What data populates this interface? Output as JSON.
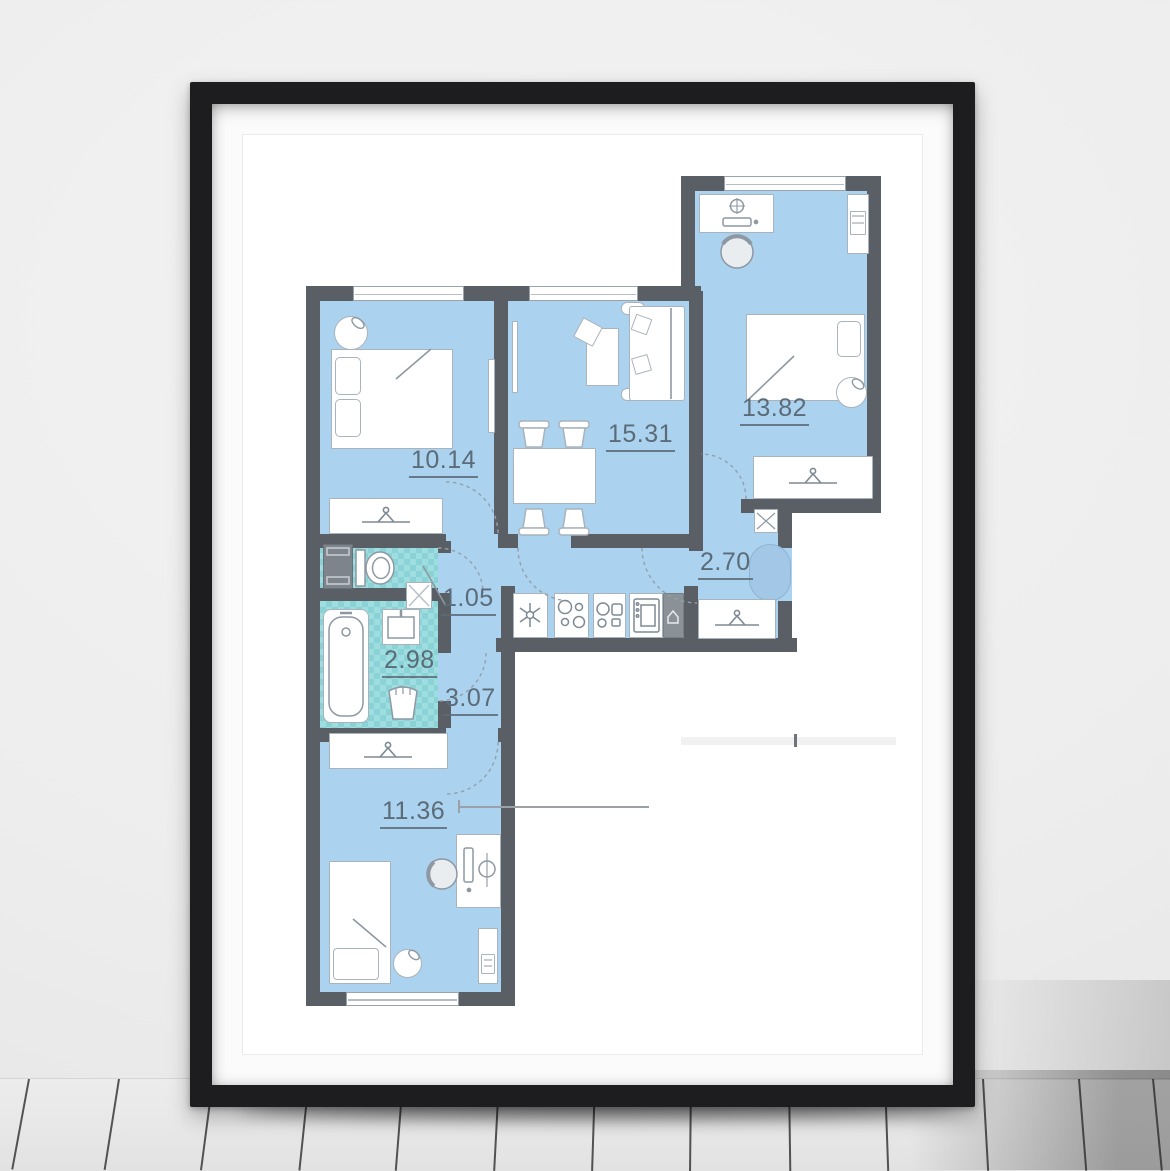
{
  "poster": {
    "kind": "apartment floor plan, black frame on white wall over whitewashed wood floor",
    "total_rooms_labeled": 8
  },
  "rooms": [
    {
      "name": "bedroom-top-left",
      "area": "10.14"
    },
    {
      "name": "living-room",
      "area": "15.31"
    },
    {
      "name": "bedroom-top-right",
      "area": "13.82"
    },
    {
      "name": "entry-hall",
      "area": "2.70"
    },
    {
      "name": "wc",
      "area": "1.05"
    },
    {
      "name": "bathroom",
      "area": "2.98"
    },
    {
      "name": "inner-hall",
      "area": "3.07"
    },
    {
      "name": "bedroom-bottom",
      "area": "11.36"
    }
  ],
  "colors": {
    "room_fill": "#abd2ef",
    "wet_room_tile": "#9edde0",
    "wall": "#5a5f66",
    "area_label": "#5c6b78",
    "entry_rug": "#a3c7e6",
    "furniture_outline": "#a9b3bc",
    "frame": "#1d1d1f",
    "paper": "#ffffff"
  },
  "icons": {
    "hanger": "wardrobe clothes-hanger glyph",
    "snowflake": "fridge snowflake glyph",
    "burners": "cooktop four-burner glyph",
    "dishes": "kitchen sink with dishes glyph",
    "oven": "oven front glyph",
    "house": "small boiler glyph",
    "cross": "electrical box cross glyph",
    "plant": "potted plant circle with leaf",
    "monitor": "desk computer glyph",
    "window": "double-line window opening",
    "door-arc": "dashed quarter-circle door swing"
  }
}
